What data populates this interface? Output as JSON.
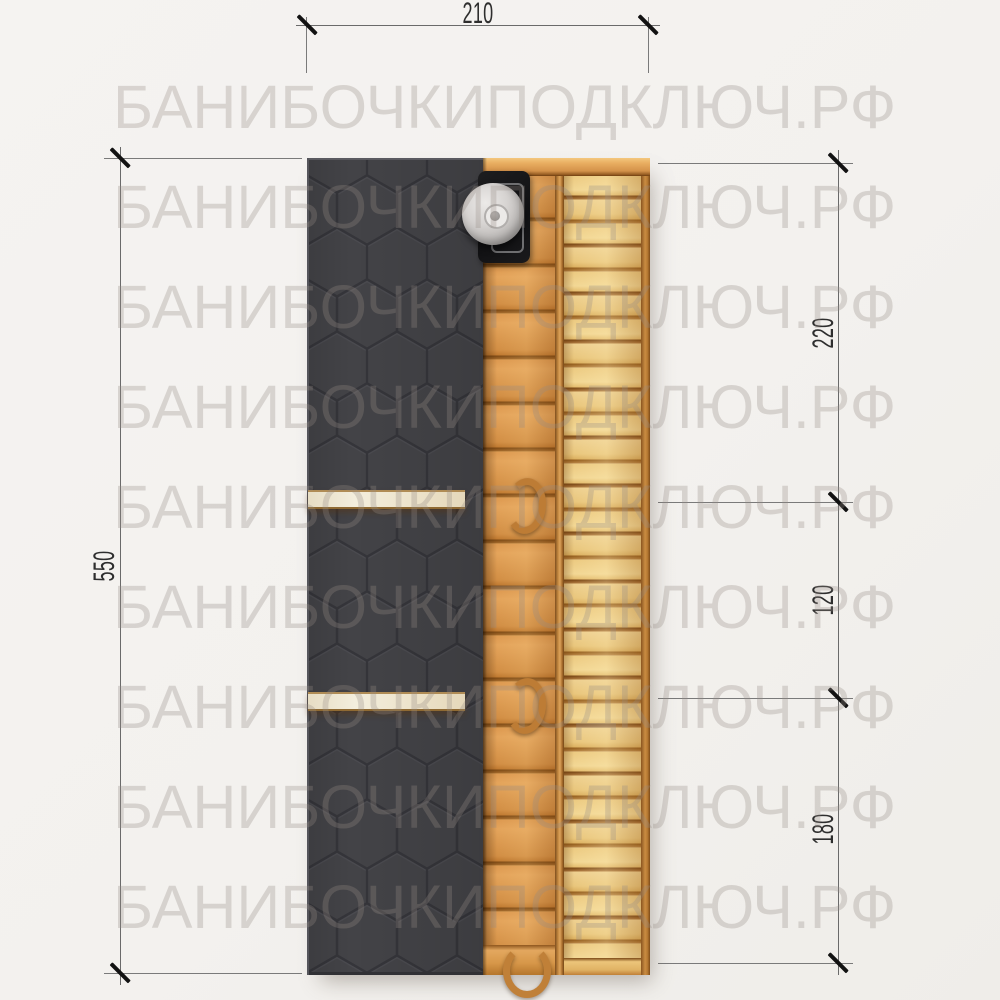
{
  "watermark": {
    "text": "БАНИБОЧКИПОДКЛЮЧ.РФ"
  },
  "dimensions": {
    "top": {
      "label": "210"
    },
    "left": {
      "label": "550"
    },
    "right_segments": [
      {
        "label": "220"
      },
      {
        "label": "120"
      },
      {
        "label": "180"
      }
    ]
  },
  "colors": {
    "background": "#f3f1ef",
    "roof_shingle": "#414145",
    "wood_light": "#ecca81",
    "wood_mid": "#dd9950",
    "wood_gap": "#7c4917",
    "partition": "#efe6cf",
    "stove": "#141414",
    "chimney_cap": "#d6d3d1",
    "dimension_line": "#6a6a6a",
    "dimension_text": "#2e2e2e",
    "watermark": "#d7d3d0"
  }
}
